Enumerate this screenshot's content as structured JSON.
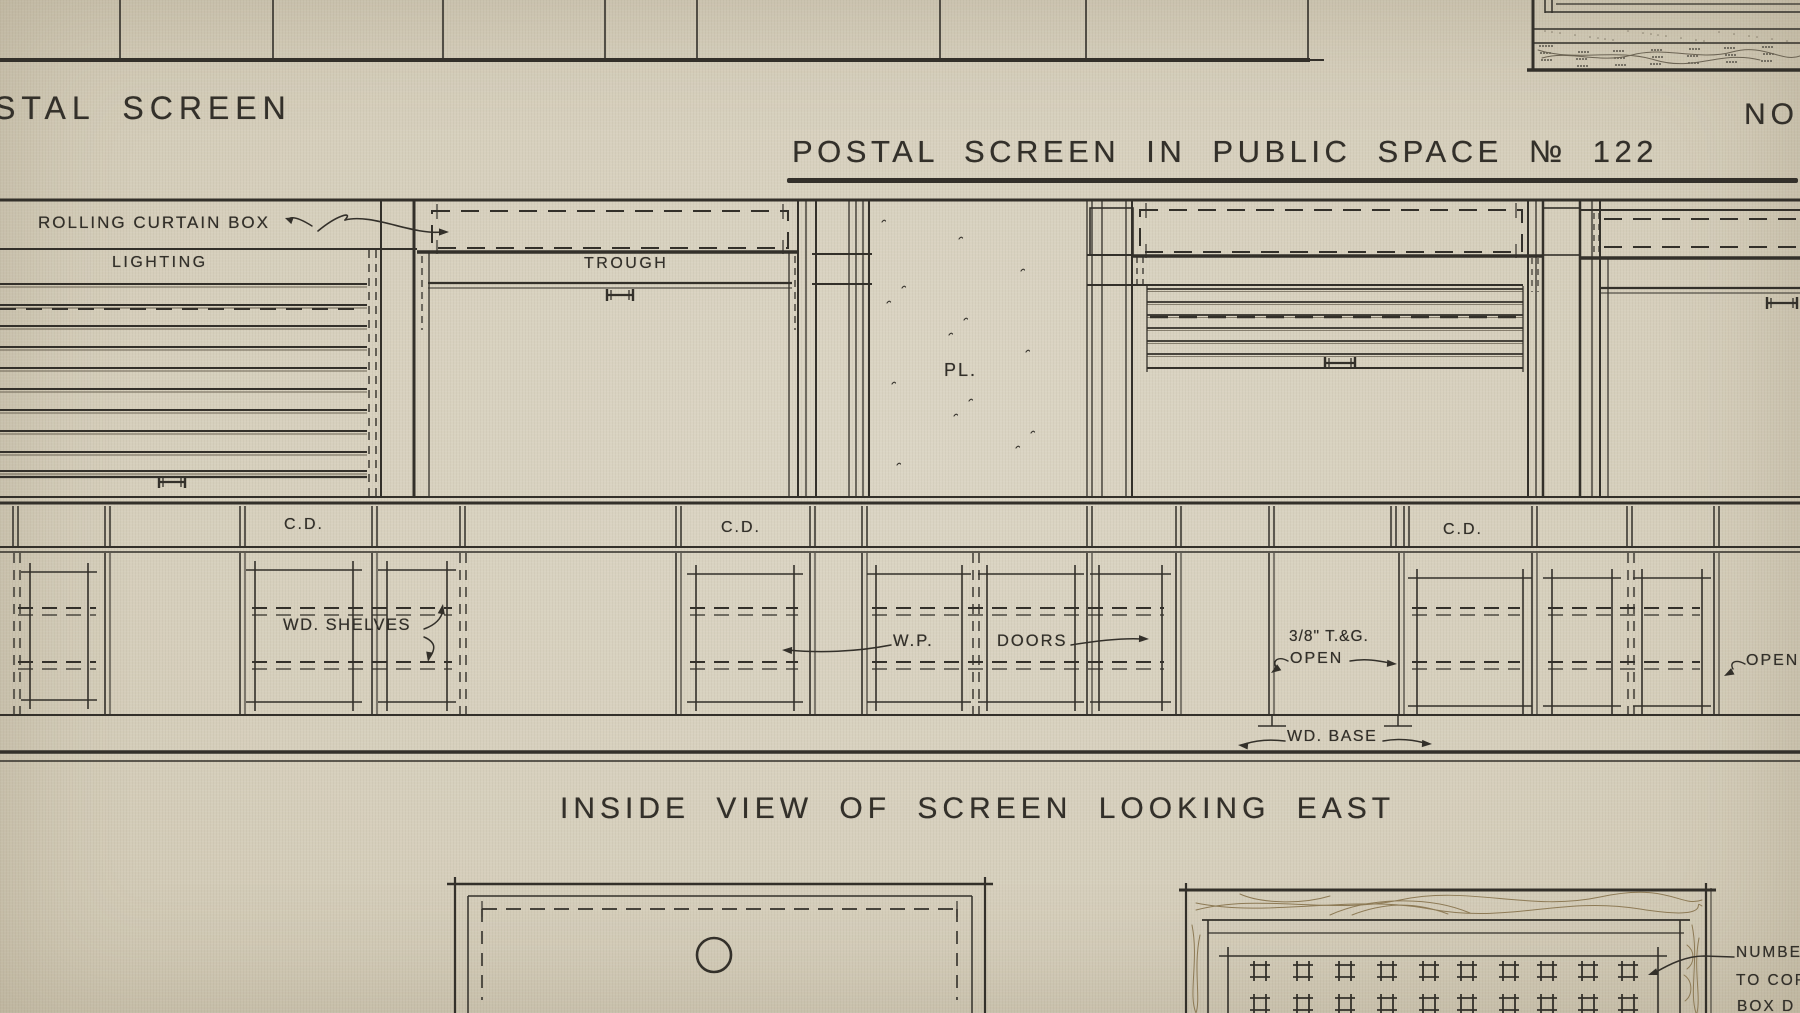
{
  "page": {
    "top_left_title": "STAL SCREEN",
    "top_right_title": "No",
    "main_title": "POSTAL SCREEN IN PUBLIC SPACE № 122",
    "section_title": "INSIDE VIEW OF SCREEN LOOKING EAST"
  },
  "elevation_labels": {
    "rolling_curtain_box": "ROLLING CURTAIN BOX",
    "lighting": "LIGHTING",
    "trough": "TROUGH",
    "plaster": "PL.",
    "counter_door_1": "C.D.",
    "counter_door_2": "C.D.",
    "counter_door_3": "C.D.",
    "wood_shelves": "WD. SHELVES",
    "wp": "W.P.",
    "doors": "DOORS",
    "tongue_groove": "3/8\" T.&G.",
    "open_center": "OPEN",
    "wood_base": "WD. BASE",
    "open_right": "OPEN"
  },
  "po_box_note": {
    "line1": "NUMBE",
    "line2": "TO COR",
    "line3": "BOX D"
  },
  "colors": {
    "paper": "#d7d0be",
    "ink": "#33302a",
    "ink_soft": "#6b6353",
    "grain": "#8d7a55"
  }
}
